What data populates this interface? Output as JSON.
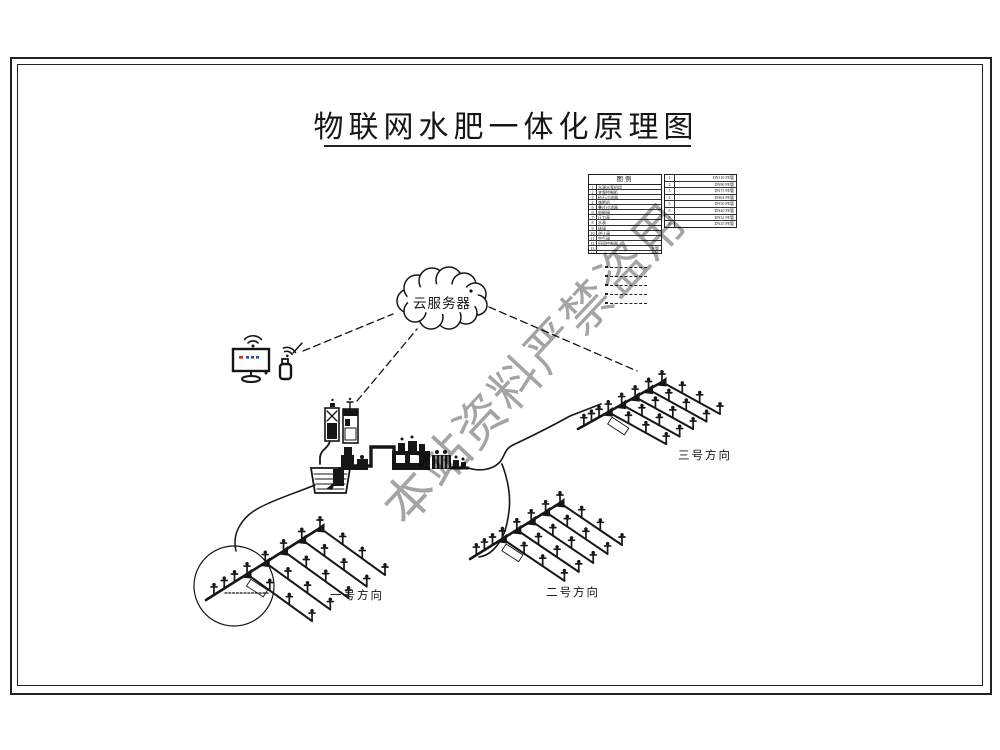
{
  "title": "物联网水肥一体化原理图",
  "cloud_label": "云服务器",
  "watermark": "本站资料严禁盗用",
  "fields": [
    {
      "label": "一号方向"
    },
    {
      "label": "二号方向"
    },
    {
      "label": "三号方向"
    }
  ],
  "legend_main": {
    "title": "图例",
    "rows": [
      {
        "no": "1",
        "label": "水源水泵机组"
      },
      {
        "no": "2",
        "label": "变频控制柜"
      },
      {
        "no": "3",
        "label": "砂石过滤器"
      },
      {
        "no": "4",
        "label": "施肥机"
      },
      {
        "no": "5",
        "label": "叠片过滤器"
      },
      {
        "no": "6",
        "label": "电磁阀"
      },
      {
        "no": "7",
        "label": "压力表"
      },
      {
        "no": "8",
        "label": "水表"
      },
      {
        "no": "9",
        "label": "球阀"
      },
      {
        "no": "10",
        "label": "逆止阀"
      },
      {
        "no": "11",
        "label": "空气阀"
      },
      {
        "no": "12",
        "label": "田间控制器"
      },
      {
        "no": "13",
        "label": "主管"
      },
      {
        "no": "14",
        "label": "支管"
      }
    ]
  },
  "legend_pipes": {
    "rows": [
      {
        "no": "1",
        "label": "DN110 PE管"
      },
      {
        "no": "2",
        "label": "DN90 PE管"
      },
      {
        "no": "3",
        "label": "DN75 PE管"
      },
      {
        "no": "4",
        "label": "DN63 PE管"
      },
      {
        "no": "5",
        "label": "DN50 PE管"
      },
      {
        "no": "6",
        "label": "DN40 PE管"
      },
      {
        "no": "7",
        "label": "DN32 PE管"
      },
      {
        "no": "8",
        "label": "DN25 PE管"
      }
    ]
  },
  "legend_line_samples": [
    "dashed-line",
    "dashed-line",
    "dashed-line",
    "dashed-line",
    "dashed-line"
  ],
  "icons": {
    "cloud": "cloud-server-icon",
    "monitor": "monitor-wifi-icon",
    "handheld": "handheld-wifi-icon",
    "sprinkler": "sprinkler-riser-icon"
  },
  "colors": {
    "line": "#161616",
    "watermark": "#979797",
    "screen_red": "#c03228",
    "screen_blue": "#2b4bb5"
  }
}
